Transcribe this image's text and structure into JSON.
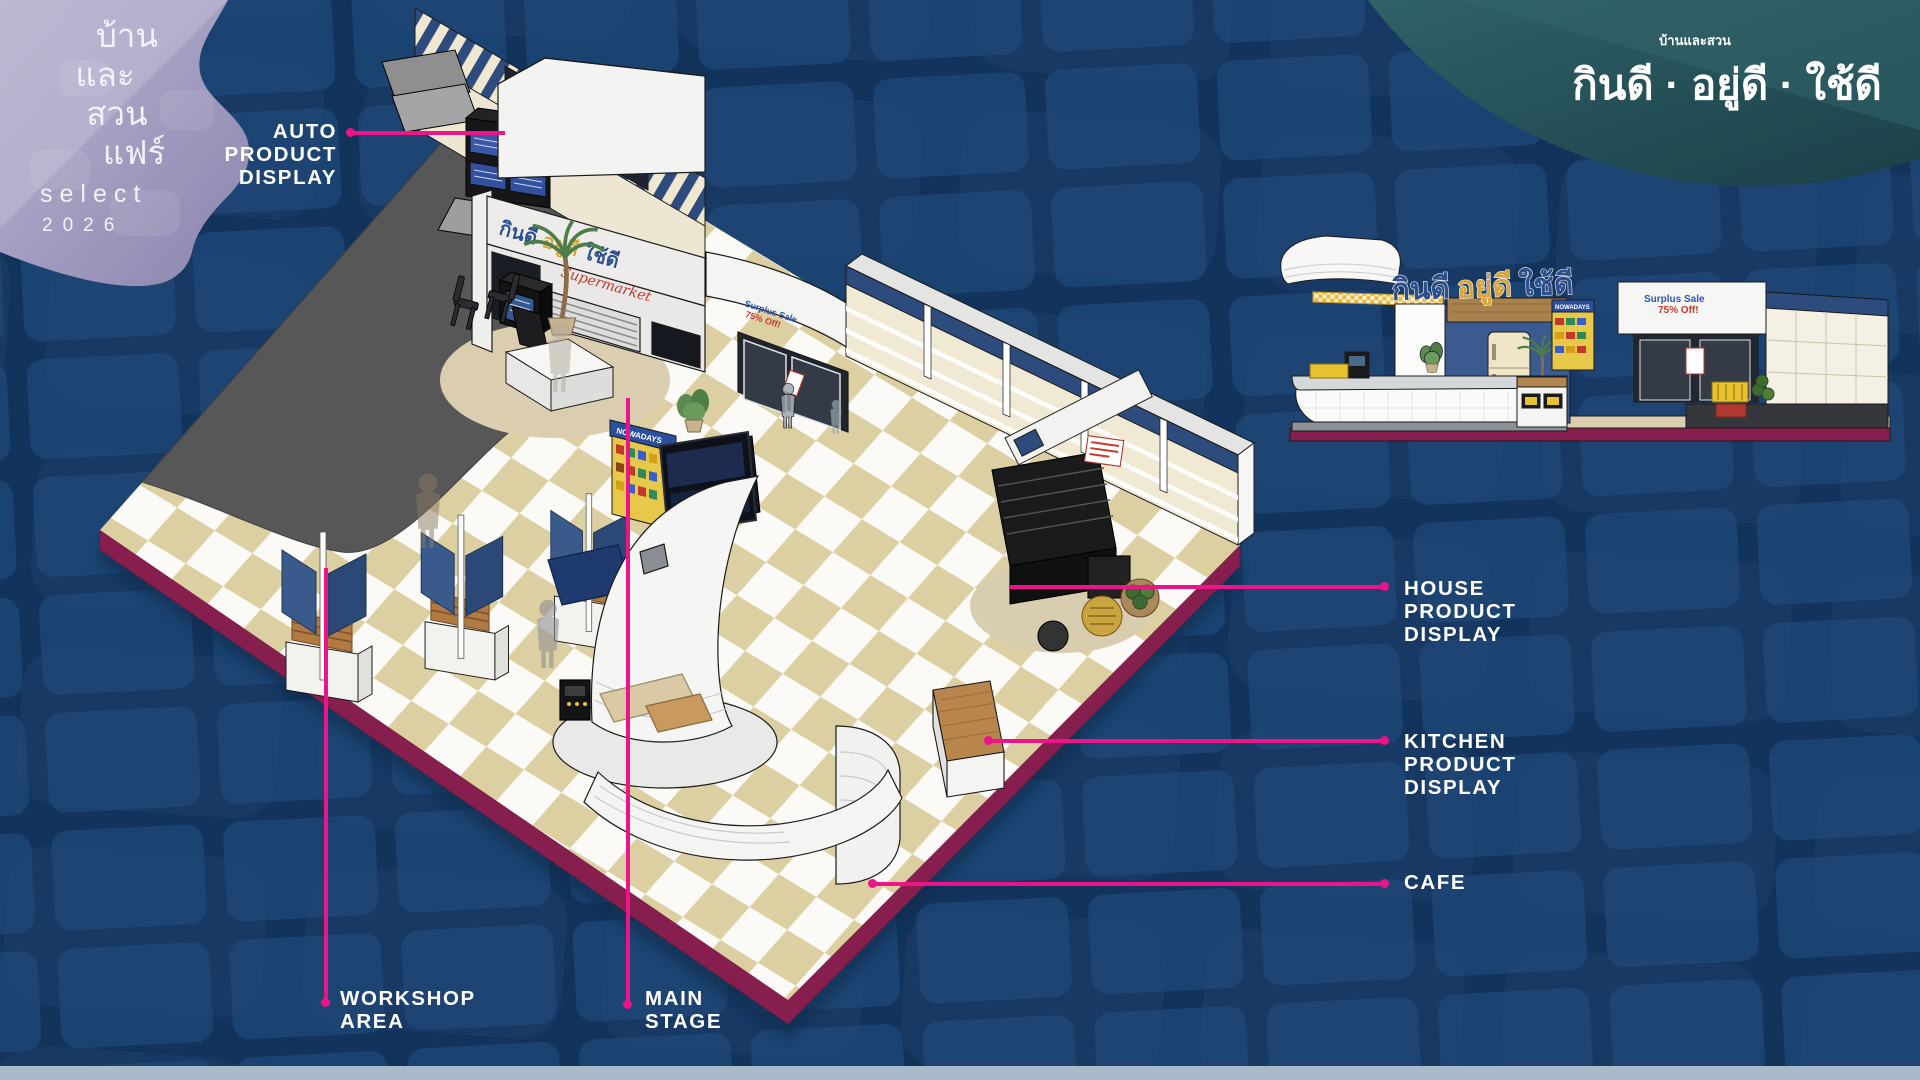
{
  "logo_badge": {
    "thai_lines": [
      "บ้าน",
      "และ",
      "สวน",
      "แฟร์"
    ],
    "select": "select",
    "year": "2026"
  },
  "tagline": {
    "small": "บ้านและสวน",
    "large": "กินดี · อยู่ดี · ใช้ดี"
  },
  "callouts": {
    "auto": {
      "lines": [
        "AUTO",
        "PRODUCT",
        "DISPLAY"
      ]
    },
    "house": {
      "lines": [
        "HOUSE",
        "PRODUCT",
        "DISPLAY"
      ]
    },
    "kitchen": {
      "lines": [
        "KITCHEN",
        "PRODUCT",
        "DISPLAY"
      ]
    },
    "cafe": {
      "lines": [
        "CAFE"
      ]
    },
    "workshop": {
      "lines": [
        "WORKSHOP",
        "AREA"
      ]
    },
    "main_stage": {
      "lines": [
        "MAIN",
        "STAGE"
      ]
    }
  },
  "scene": {
    "sign_words": [
      "กินดี",
      "อยู่ดี",
      "ใช้ดี"
    ],
    "supermarket_script": "Supermarket",
    "nowadays_sign": "NOWADAYS",
    "surplus_line1": "Surplus Sale",
    "surplus_line2": "75% Off!"
  },
  "colors": {
    "accent_pink": "#EB1489",
    "platform_maroon": "#871F4E",
    "checker_tan": "#DCCFA1",
    "carpet_gray": "#575757",
    "shelf_navy": "#2E4B7E",
    "background_navy": "#12335C"
  }
}
